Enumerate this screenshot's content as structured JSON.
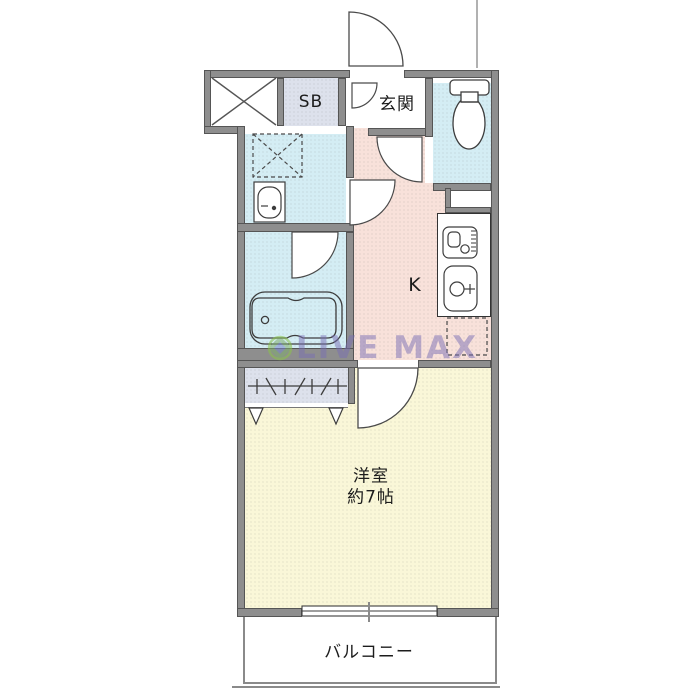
{
  "plan": {
    "title": "apartment-floor-plan",
    "watermark": {
      "text": "LIVE MAX"
    },
    "rooms": {
      "shoebox": {
        "label": "SB"
      },
      "entrance": {
        "label": "玄関"
      },
      "kitchen": {
        "label": "K"
      },
      "western_room": {
        "label": "洋室",
        "size": "約7帖"
      },
      "balcony": {
        "label": "バルコニー"
      }
    },
    "fixtures": [
      "toilet",
      "washbasin",
      "washing-machine-space",
      "bathtub",
      "stove",
      "kitchen-sink",
      "refrigerator-space",
      "closet-hanger-rail"
    ],
    "colors": {
      "wall": "#8e8e8e",
      "hall_kitchen_floor": "#f8e1da",
      "wet_area_floor": "#d4edf4",
      "room_floor": "#faf7d8",
      "storage_fill": "#dde1ec",
      "watermark": "#786eb4"
    }
  }
}
